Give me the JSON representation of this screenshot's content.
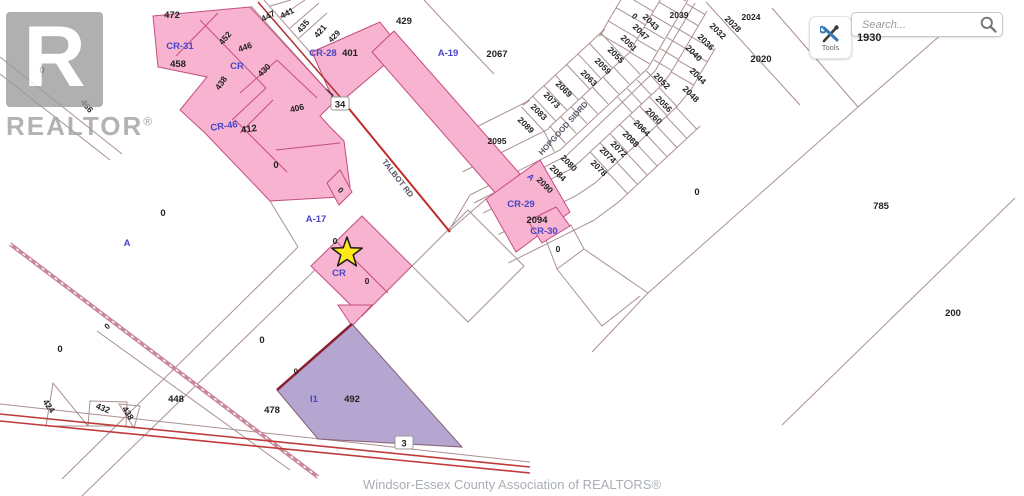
{
  "watermark": {
    "letter": "R",
    "brand": "REALTOR",
    "reg": "®"
  },
  "toolbar": {
    "tools_label": "Tools",
    "search_placeholder": "Search...",
    "lot_label": "1930"
  },
  "attribution": "Windsor-Essex County Association of REALTORS®",
  "map": {
    "colors": {
      "pink": "#f7b3d0",
      "pink_border": "#c64d7e",
      "purple": "#b4a6d0",
      "purple_border": "#8a5d72",
      "line": "#ab9090",
      "road_red": "#c22a2a",
      "dark_red": "#8b1f2f",
      "blue_label": "#4646c8",
      "black_label": "#222222",
      "road_label": "#555566",
      "star_fill": "#ffe81a",
      "star_stroke": "#1a1a1a"
    },
    "star": {
      "x": 347,
      "y": 253
    },
    "labels": [
      {
        "t": "0",
        "x": 42,
        "y": 70
      },
      {
        "t": "466",
        "x": 87,
        "y": 106,
        "r": 50,
        "s": 8.5
      },
      {
        "t": "472",
        "x": 172,
        "y": 15
      },
      {
        "t": "CR-31",
        "x": 180,
        "y": 46,
        "c": "blue"
      },
      {
        "t": "458",
        "x": 178,
        "y": 64
      },
      {
        "t": "452",
        "x": 225,
        "y": 38,
        "r": -50,
        "s": 8.5
      },
      {
        "t": "446",
        "x": 245,
        "y": 47,
        "r": -20,
        "s": 8.5
      },
      {
        "t": "CR",
        "x": 237,
        "y": 66,
        "c": "blue"
      },
      {
        "t": "438",
        "x": 221,
        "y": 83,
        "r": -55,
        "s": 8.5
      },
      {
        "t": "430",
        "x": 264,
        "y": 70,
        "r": -45,
        "s": 8.5
      },
      {
        "t": "447",
        "x": 268,
        "y": 16,
        "r": -28,
        "s": 8.5
      },
      {
        "t": "441",
        "x": 287,
        "y": 13,
        "r": -28,
        "s": 8.5
      },
      {
        "t": "435",
        "x": 303,
        "y": 26,
        "r": -50,
        "s": 8.5
      },
      {
        "t": "421",
        "x": 320,
        "y": 31,
        "r": -50,
        "s": 8.5
      },
      {
        "t": "429",
        "x": 334,
        "y": 36,
        "r": -45,
        "s": 8
      },
      {
        "t": "CR-28",
        "x": 323,
        "y": 53,
        "c": "blue"
      },
      {
        "t": "401",
        "x": 350,
        "y": 53
      },
      {
        "t": "429",
        "x": 404,
        "y": 21
      },
      {
        "t": "A-19",
        "x": 448,
        "y": 53,
        "c": "blue"
      },
      {
        "t": "2067",
        "x": 497,
        "y": 54
      },
      {
        "t": "406",
        "x": 297,
        "y": 108,
        "r": -14,
        "s": 8.5
      },
      {
        "t": "CR-46",
        "x": 224,
        "y": 126,
        "r": -8,
        "c": "blue"
      },
      {
        "t": "412",
        "x": 249,
        "y": 129,
        "r": -8
      },
      {
        "t": "0",
        "x": 276,
        "y": 165
      },
      {
        "t": "34",
        "x": 340,
        "y": 105,
        "box": true
      },
      {
        "t": "TALBOT RD",
        "x": 398,
        "y": 178,
        "r": 52,
        "c": "road",
        "s": 8
      },
      {
        "t": "0",
        "x": 341,
        "y": 190,
        "r": 45,
        "s": 8
      },
      {
        "t": "A-17",
        "x": 316,
        "y": 219,
        "c": "blue"
      },
      {
        "t": "0",
        "x": 335,
        "y": 241,
        "s": 8.5
      },
      {
        "t": "CR",
        "x": 339,
        "y": 273,
        "c": "blue"
      },
      {
        "t": "0",
        "x": 367,
        "y": 281,
        "s": 8.5
      },
      {
        "t": "A",
        "x": 127,
        "y": 243,
        "c": "blue"
      },
      {
        "t": "0",
        "x": 163,
        "y": 213
      },
      {
        "t": "0",
        "x": 60,
        "y": 349
      },
      {
        "t": "0",
        "x": 107,
        "y": 326,
        "r": -45,
        "s": 8
      },
      {
        "t": "0",
        "x": 262,
        "y": 340
      },
      {
        "t": "424",
        "x": 49,
        "y": 406,
        "r": 55,
        "s": 8.5
      },
      {
        "t": "432",
        "x": 103,
        "y": 408,
        "r": 22,
        "s": 8.5
      },
      {
        "t": "438",
        "x": 128,
        "y": 413,
        "r": 58,
        "s": 8.5
      },
      {
        "t": "448",
        "x": 176,
        "y": 399
      },
      {
        "t": "478",
        "x": 272,
        "y": 410
      },
      {
        "t": "0",
        "x": 296,
        "y": 371,
        "r": -20,
        "s": 8
      },
      {
        "t": "I1",
        "x": 314,
        "y": 399,
        "c": "blue"
      },
      {
        "t": "492",
        "x": 352,
        "y": 399
      },
      {
        "t": "3",
        "x": 404,
        "y": 444,
        "box": true
      },
      {
        "t": "HOPGOOD SIDRD",
        "x": 563,
        "y": 128,
        "r": -48,
        "c": "road",
        "s": 8
      },
      {
        "t": "0",
        "x": 635,
        "y": 16,
        "r": 45,
        "s": 8
      },
      {
        "t": "2043",
        "x": 651,
        "y": 22,
        "r": 45,
        "s": 8.5
      },
      {
        "t": "2047",
        "x": 641,
        "y": 32,
        "r": 45,
        "s": 8.5
      },
      {
        "t": "2051",
        "x": 629,
        "y": 43,
        "r": 45,
        "s": 8.5
      },
      {
        "t": "2055",
        "x": 616,
        "y": 55,
        "r": 45,
        "s": 8.5
      },
      {
        "t": "2059",
        "x": 603,
        "y": 66,
        "r": 45,
        "s": 8.5
      },
      {
        "t": "2063",
        "x": 589,
        "y": 78,
        "r": 45,
        "s": 8.5
      },
      {
        "t": "2069",
        "x": 564,
        "y": 89,
        "r": 45,
        "s": 8.5
      },
      {
        "t": "2073",
        "x": 552,
        "y": 100,
        "r": 45,
        "s": 8.5
      },
      {
        "t": "2083",
        "x": 539,
        "y": 112,
        "r": 45,
        "s": 8.5
      },
      {
        "t": "2089",
        "x": 526,
        "y": 125,
        "r": 45,
        "s": 8.5
      },
      {
        "t": "2095",
        "x": 497,
        "y": 141,
        "s": 8.5
      },
      {
        "t": "2080",
        "x": 569,
        "y": 163,
        "r": 45,
        "s": 8.5
      },
      {
        "t": "2084",
        "x": 558,
        "y": 173,
        "r": 45,
        "s": 8.5
      },
      {
        "t": "A",
        "x": 531,
        "y": 177,
        "r": 45,
        "c": "blue",
        "s": 8.5
      },
      {
        "t": "2090",
        "x": 545,
        "y": 185,
        "r": 45,
        "s": 8.5
      },
      {
        "t": "CR-29",
        "x": 521,
        "y": 204,
        "c": "blue"
      },
      {
        "t": "2094",
        "x": 537,
        "y": 220
      },
      {
        "t": "CR-30",
        "x": 544,
        "y": 231,
        "c": "blue"
      },
      {
        "t": "0",
        "x": 558,
        "y": 249,
        "s": 8.5
      },
      {
        "t": "2039",
        "x": 679,
        "y": 15,
        "s": 8.5
      },
      {
        "t": "2032",
        "x": 718,
        "y": 31,
        "r": 45,
        "s": 8.5
      },
      {
        "t": "2036",
        "x": 706,
        "y": 42,
        "r": 45,
        "s": 8.5
      },
      {
        "t": "2028",
        "x": 733,
        "y": 24,
        "r": 45,
        "s": 8.5
      },
      {
        "t": "2024",
        "x": 751,
        "y": 17,
        "s": 8.5
      },
      {
        "t": "2040",
        "x": 694,
        "y": 53,
        "r": 45,
        "s": 8.5
      },
      {
        "t": "2044",
        "x": 698,
        "y": 76,
        "r": 45,
        "s": 8.5
      },
      {
        "t": "2048",
        "x": 691,
        "y": 94,
        "r": 45,
        "s": 8.5
      },
      {
        "t": "2052",
        "x": 662,
        "y": 81,
        "r": 45,
        "s": 8.5
      },
      {
        "t": "2056",
        "x": 664,
        "y": 104,
        "r": 45,
        "s": 8.5
      },
      {
        "t": "2060",
        "x": 654,
        "y": 116,
        "r": 45,
        "s": 8.5
      },
      {
        "t": "2064",
        "x": 642,
        "y": 128,
        "r": 45,
        "s": 8.5
      },
      {
        "t": "2068",
        "x": 631,
        "y": 139,
        "r": 45,
        "s": 8.5
      },
      {
        "t": "2072",
        "x": 619,
        "y": 149,
        "r": 45,
        "s": 8.5
      },
      {
        "t": "2074",
        "x": 608,
        "y": 155,
        "r": 45,
        "s": 8.5
      },
      {
        "t": "2078",
        "x": 599,
        "y": 168,
        "r": 45,
        "s": 8.5
      },
      {
        "t": "2020",
        "x": 761,
        "y": 59
      },
      {
        "t": "0",
        "x": 697,
        "y": 192
      },
      {
        "t": "785",
        "x": 881,
        "y": 206
      },
      {
        "t": "200",
        "x": 953,
        "y": 313
      }
    ]
  }
}
